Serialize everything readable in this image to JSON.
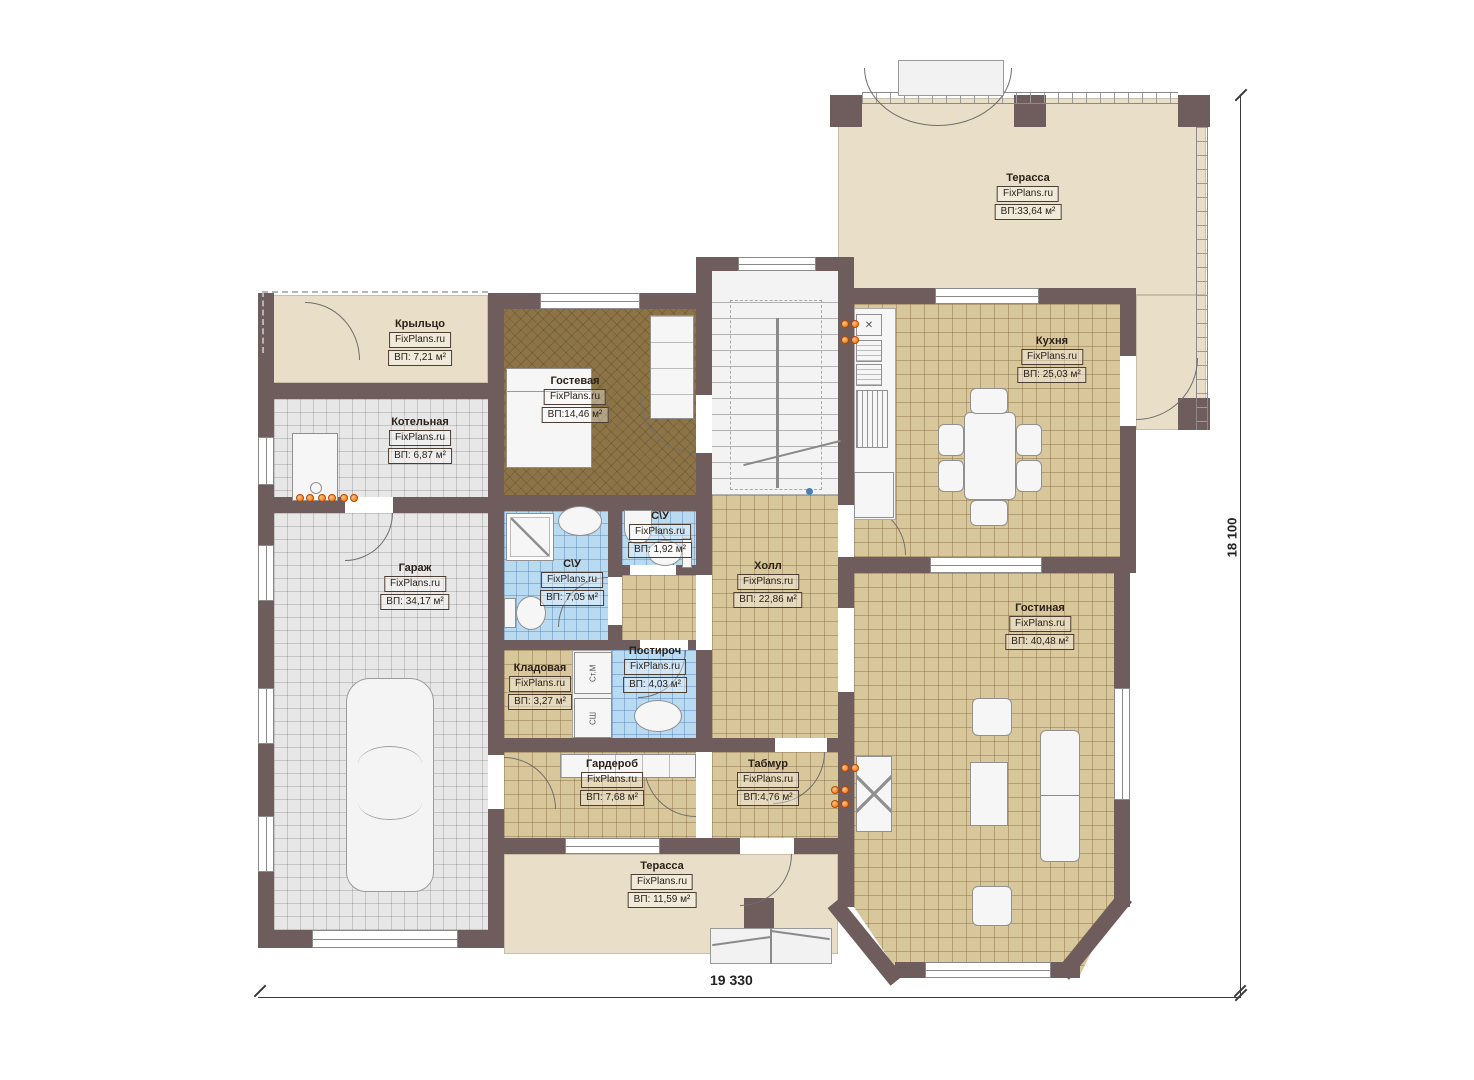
{
  "watermark": "FixPlans.ru",
  "rooms": [
    {
      "id": "terrace-top",
      "name": "Терасса",
      "area": "ВП:33,64 м²"
    },
    {
      "id": "porch",
      "name": "Крыльцо",
      "area": "ВП: 7,21 м²"
    },
    {
      "id": "boiler",
      "name": "Котельная",
      "area": "ВП: 6,87 м²"
    },
    {
      "id": "guest",
      "name": "Гостевая",
      "area": "ВП:14,46 м²"
    },
    {
      "id": "kitchen",
      "name": "Кухня",
      "area": "ВП: 25,03 м²"
    },
    {
      "id": "garage",
      "name": "Гараж",
      "area": "ВП: 34,17 м²"
    },
    {
      "id": "bath-big",
      "name": "С\\У",
      "area": "ВП: 7,05 м²"
    },
    {
      "id": "bath-small",
      "name": "С\\У",
      "area": "ВП: 1,92 м²"
    },
    {
      "id": "hall",
      "name": "Холл",
      "area": "ВП: 22,86 м²"
    },
    {
      "id": "living",
      "name": "Гостиная",
      "area": "ВП: 40,48 м²"
    },
    {
      "id": "storage",
      "name": "Кладовая",
      "area": "ВП: 3,27 м²"
    },
    {
      "id": "laundry",
      "name": "Постироч",
      "area": "ВП: 4,03 м²"
    },
    {
      "id": "wardrobe",
      "name": "Гардероб",
      "area": "ВП: 7,68 м²"
    },
    {
      "id": "tambour",
      "name": "Табмур",
      "area": "ВП:4,76 м²"
    },
    {
      "id": "terrace-bottom",
      "name": "Терасса",
      "area": "ВП: 11,59 м²"
    }
  ],
  "appliances": {
    "washer": "Ст.М",
    "dryer": "СШ"
  },
  "icons": {
    "vent": "✕"
  },
  "dims": {
    "bottom": "19 330",
    "right": "18 100"
  },
  "colors": {
    "wall": "#6f5d5d",
    "terrace": "#e9dfc8",
    "tile_tan": "#d9c79c",
    "tile_gray": "#e7e7e7",
    "tile_blue": "#b9dbf2",
    "carpet": "#8d7446",
    "radiator": "#ef6c0a"
  }
}
